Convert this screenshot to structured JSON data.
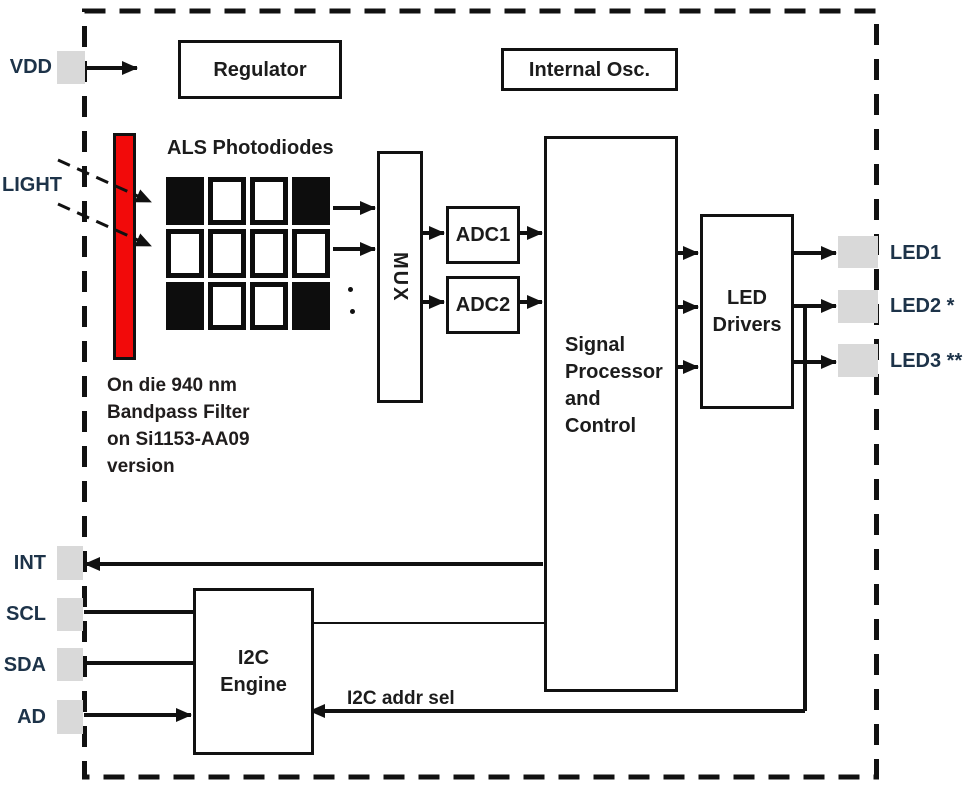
{
  "pins": {
    "left": [
      {
        "id": "vdd",
        "label": "VDD"
      },
      {
        "id": "int",
        "label": "INT"
      },
      {
        "id": "scl",
        "label": "SCL"
      },
      {
        "id": "sda",
        "label": "SDA"
      },
      {
        "id": "ad",
        "label": "AD"
      }
    ],
    "right": [
      {
        "id": "led1",
        "label": "LED1"
      },
      {
        "id": "led2",
        "label": "LED2 *"
      },
      {
        "id": "led3",
        "label": "LED3 **"
      }
    ]
  },
  "blocks": {
    "regulator": {
      "label": "Regulator"
    },
    "internal_osc": {
      "label": "Internal Osc."
    },
    "mux": {
      "label": "MUX"
    },
    "adc1": {
      "label": "ADC1"
    },
    "adc2": {
      "label": "ADC2"
    },
    "signal_processor": {
      "lines": [
        "Signal",
        "Processor",
        "and",
        "Control"
      ]
    },
    "led_drivers": {
      "lines": [
        "LED",
        "Drivers"
      ]
    },
    "i2c_engine": {
      "lines": [
        "I2C",
        "Engine"
      ]
    }
  },
  "photodiodes": {
    "label": "ALS Photodiodes",
    "grid": [
      [
        1,
        0,
        0,
        1
      ],
      [
        0,
        0,
        0,
        0
      ],
      [
        1,
        0,
        0,
        1
      ]
    ],
    "more_channels_indicator": ".."
  },
  "annotations": {
    "light_label": "LIGHT",
    "filter_note_lines": [
      "On die 940 nm",
      "Bandpass Filter",
      "on Si1153-AA09",
      "version"
    ],
    "i2c_addr_sel_label": "I2C addr sel"
  },
  "colors": {
    "filter_red": "#F20A0A",
    "pad_gray": "#D9D9D9",
    "line_black": "#111111",
    "pin_label_color": "#1d3349"
  }
}
